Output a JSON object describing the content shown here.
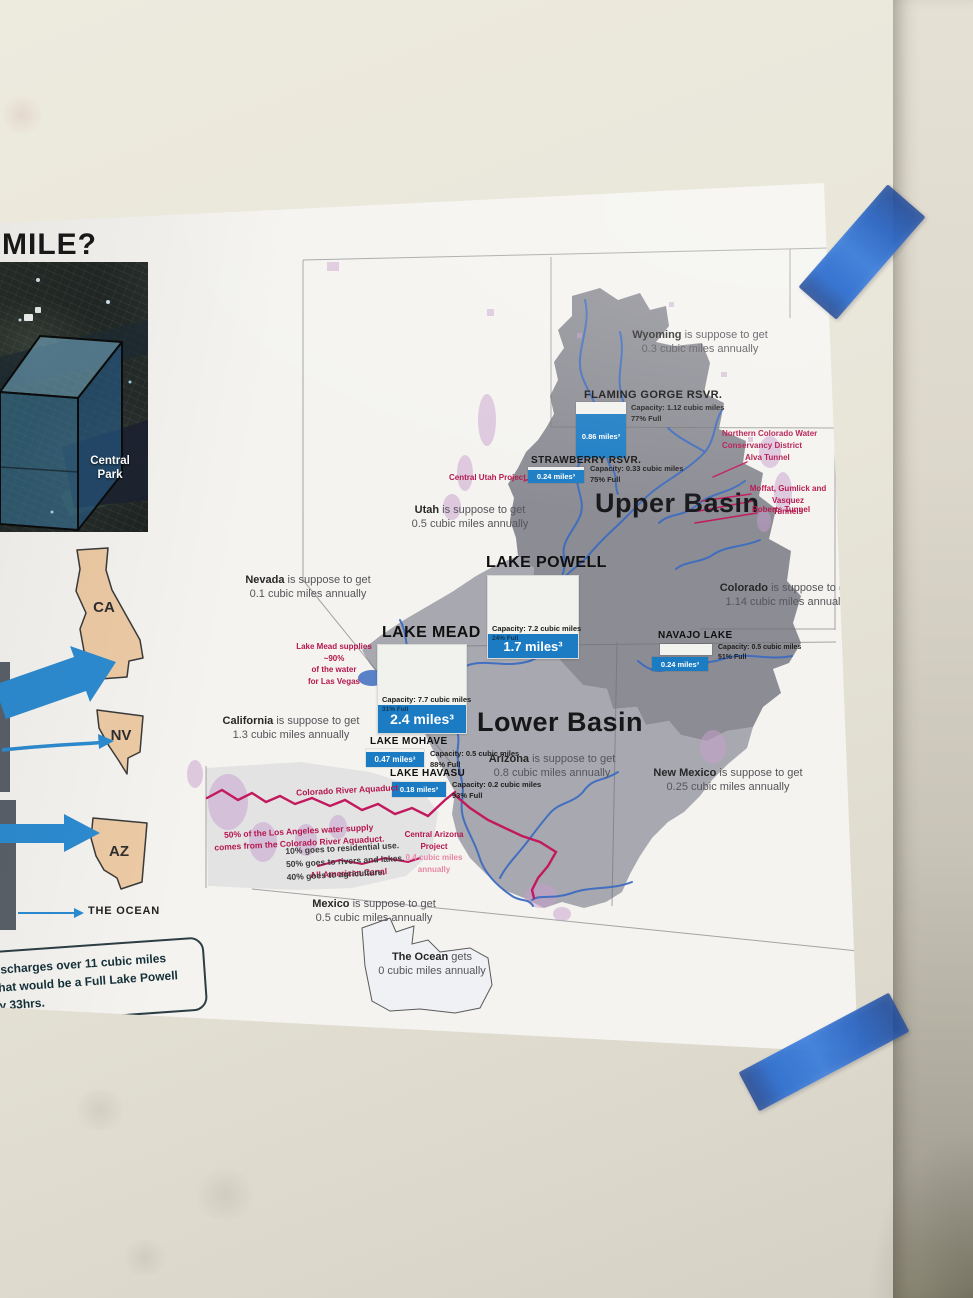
{
  "poster": {
    "title_fragment": "MILE?",
    "central_park_label": "Central Park",
    "states": [
      {
        "abbr": "CA"
      },
      {
        "abbr": "NV"
      },
      {
        "abbr": "AZ"
      }
    ],
    "ocean_label": "THE OCEAN",
    "footnote_lines": [
      "ischarges over 11 cubic miles",
      "hat would be a Full Lake Powell",
      "y 33hrs."
    ]
  },
  "map": {
    "upper_basin_label": "Upper Basin",
    "lower_basin_label": "Lower Basin",
    "allocations": [
      {
        "name": "Wyoming",
        "verb": "is suppose to get",
        "amount": "0.3 cubic miles annually"
      },
      {
        "name": "Utah",
        "verb": "is suppose to get",
        "amount": "0.5 cubic miles annually"
      },
      {
        "name": "Nevada",
        "verb": "is suppose to get",
        "amount": "0.1 cubic miles annually"
      },
      {
        "name": "Colorado",
        "verb": "is suppose to get",
        "amount": "1.14 cubic miles annually"
      },
      {
        "name": "California",
        "verb": "is suppose to get",
        "amount": "1.3 cubic miles annually"
      },
      {
        "name": "Arizona",
        "verb": "is suppose to get",
        "amount": "0.8 cubic miles annually"
      },
      {
        "name": "New Mexico",
        "verb": "is suppose to get",
        "amount": "0.25 cubic miles annually"
      },
      {
        "name": "Mexico",
        "verb": "is suppose to get",
        "amount": "0.5 cubic miles annually"
      },
      {
        "name": "The Ocean",
        "verb": "gets",
        "amount": "0 cubic miles annually"
      }
    ],
    "reservoirs": [
      {
        "name": "FLAMING GORGE RSVR.",
        "capacity": "Capacity: 1.12 cubic miles",
        "percent_full": "77% Full",
        "volume": "0.86 miles³"
      },
      {
        "name": "STRAWBERRY RSVR.",
        "capacity": "Capacity: 0.33 cubic miles",
        "percent_full": "75% Full",
        "volume": "0.24 miles³"
      },
      {
        "name": "LAKE POWELL",
        "capacity": "Capacity: 7.2 cubic miles",
        "percent_full": "24% Full",
        "volume": "1.7 miles³"
      },
      {
        "name": "LAKE MEAD",
        "capacity": "Capacity: 7.7 cubic miles",
        "percent_full": "31% Full",
        "volume": "2.4 miles³"
      },
      {
        "name": "NAVAJO LAKE",
        "capacity": "Capacity: 0.5 cubic miles",
        "percent_full": "51% Full",
        "volume": "0.24 miles³"
      },
      {
        "name": "LAKE MOHAVE",
        "capacity": "Capacity: 0.5 cubic miles",
        "percent_full": "88% Full",
        "volume": "0.47 miles³"
      },
      {
        "name": "LAKE HAVASU",
        "capacity": "Capacity: 0.2 cubic miles",
        "percent_full": "93% Full",
        "volume": "0.18 miles³"
      }
    ],
    "red_notes": {
      "northern_colorado_1": "Northern Colorado Water",
      "northern_colorado_2": "Conservancy District",
      "alva": "Alva Tunnel",
      "moffat_1": "Moffat, Gumlick and Vasquez",
      "moffat_2": "Tunnels",
      "roberts": "Roberts Tunnel",
      "central_utah": "Central Utah Project",
      "mead_supply_1": "Lake Mead supplies ~90%",
      "mead_supply_2": "of the water",
      "mead_supply_3": "for Las Vegas",
      "aquaduct": "Colorado River Aquaduct",
      "la_supply_1": "50% of the Los Angeles water supply",
      "la_supply_2": "comes from the Colorado River Aquaduct.",
      "cap_1": "Central Arizona Project",
      "cap_2": "0.4 cubic miles annually",
      "all_american": "All American Canal"
    },
    "usage_note": [
      "10% goes to residential use.",
      "50% goes to rivers and lakes.",
      "40% goes to agriculture."
    ]
  },
  "colors": {
    "bar_blue": "#1b7cc4",
    "tape_blue": "#2f6fd0",
    "canal_red": "#c2195e",
    "arrow_blue": "#2d8bd0",
    "upper_basin_gray": "#8c8c94",
    "lower_basin_gray": "#a8a8b0",
    "state_tan": "#eccaa4"
  }
}
